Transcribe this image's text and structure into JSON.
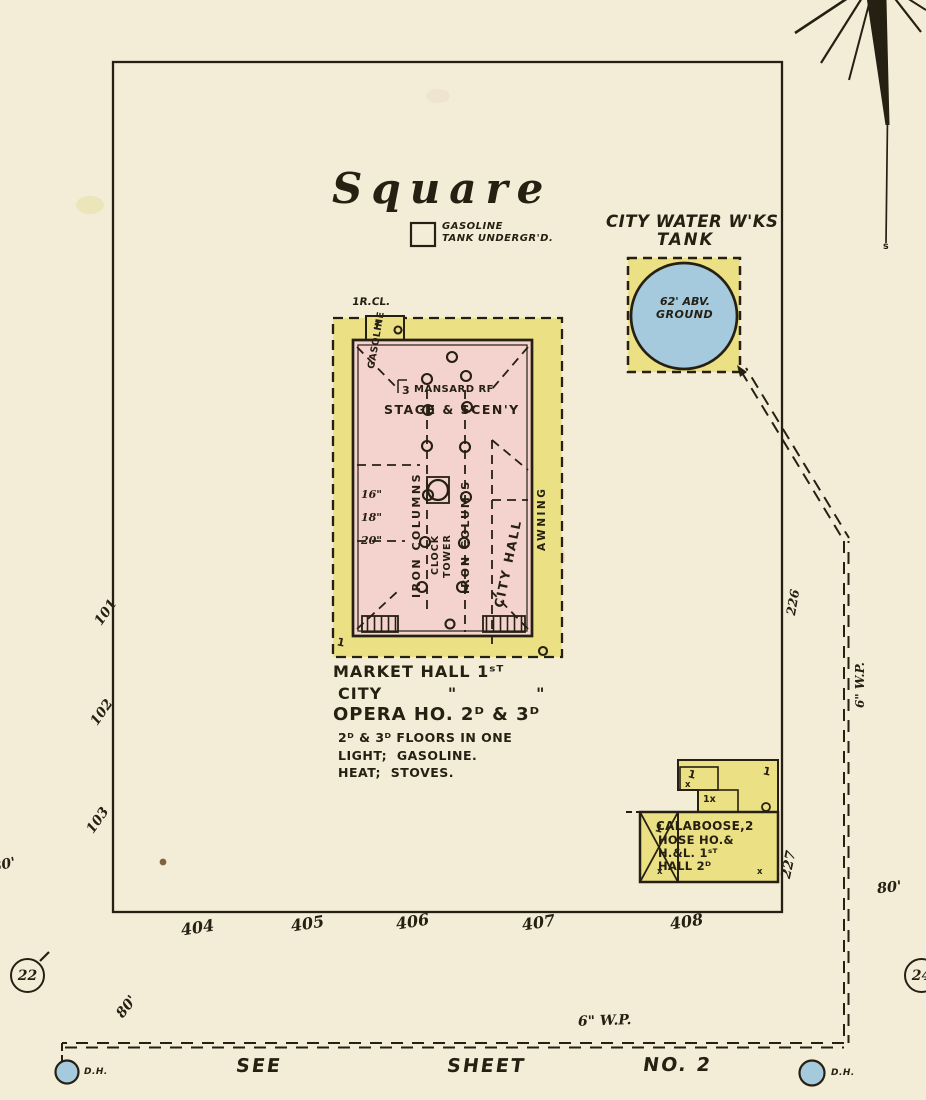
{
  "colors": {
    "paper": "#f3edd8",
    "ink": "#262013",
    "building_pink": "#f4d2ce",
    "porch_yellow": "#ebe083",
    "water_blue": "#a5cadd"
  },
  "compass": {
    "south": "s"
  },
  "square": {
    "title": "Square"
  },
  "gasoline_tank_note": {
    "line1": "GASOLINE",
    "line2": "TANK UNDERGR'D."
  },
  "water_tank": {
    "label1": "CITY WATER W'KS",
    "label2": "TANK",
    "elev1": "62' ABV.",
    "elev2": "GROUND"
  },
  "market_hall": {
    "rcl": "1R.CL.",
    "rcl_story": "1",
    "gasoline_side": "GASOLINE",
    "story_mark": "3",
    "mansard": "MANSARD RF",
    "stage": "STAGE & SCEN'Y",
    "columns_left": "IRON COLUMNS",
    "columns_mid": "IRON COLUM'S",
    "clock_line1": "CLOCK",
    "clock_line2": "TOWER",
    "city_hall": "CITY HALL",
    "awning": "AWNING",
    "porch_story": "1",
    "widths": [
      "16\"",
      "18\"",
      "20\""
    ],
    "caption": [
      "MARKET HALL 1ˢᵀ",
      "CITY          \"            \"",
      "OPERA HO. 2ᴰ & 3ᴰ",
      "2ᴰ & 3ᴰ FLOORS IN ONE",
      "LIGHT;  GASOLINE.",
      "HEAT;  STOVES."
    ]
  },
  "calaboose": {
    "lines": [
      "CALABOOSE,2",
      "HOSE HO.&",
      "H.&L. 1ˢᵀ",
      "HALL 2ᴰ"
    ],
    "marks": {
      "box1": "1",
      "box1x": "x",
      "mid": "1x",
      "right1": "1",
      "xbox1": "1",
      "xboxx": "x",
      "mainx": "x"
    }
  },
  "street_numbers": [
    "404",
    "405",
    "406",
    "407",
    "408"
  ],
  "lot_numbers": [
    "101",
    "102",
    "103"
  ],
  "distances": {
    "d226": "226",
    "d227": "227",
    "eighty_left": "80'",
    "eighty_right": "80'",
    "eighty_bottom": "80'"
  },
  "pipes": {
    "vertical_label": "6\" W.P.",
    "bottom_label": "6\" W.P."
  },
  "hydrants": {
    "left": "D.H.",
    "right": "D.H."
  },
  "sheet_refs": {
    "left": "22",
    "right": "24"
  },
  "see_sheet": {
    "w1": "SEE",
    "w2": "SHEET",
    "w3": "NO. 2"
  }
}
